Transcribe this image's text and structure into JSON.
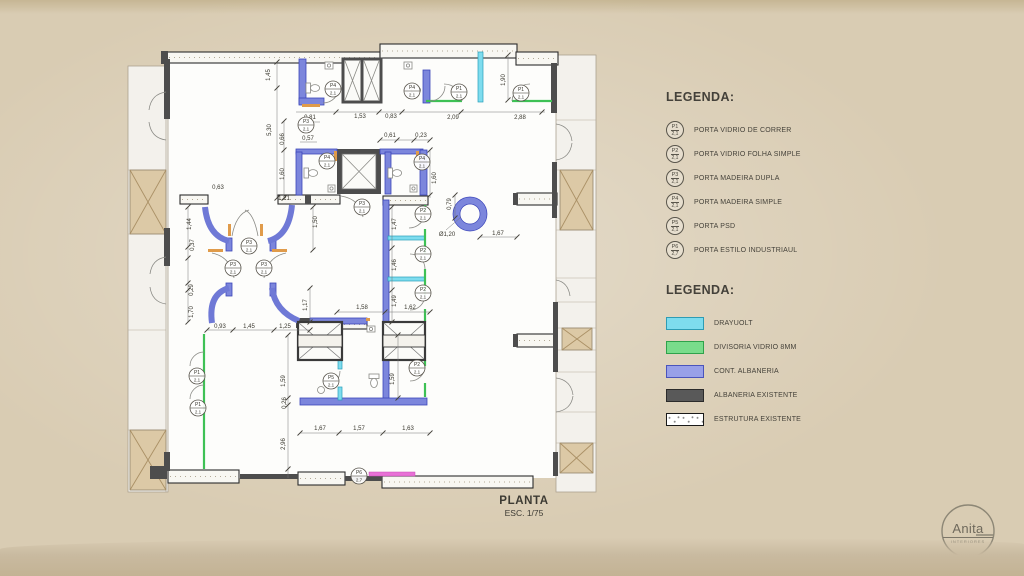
{
  "door_legend": {
    "title": "LEGENDA:",
    "items": [
      {
        "tag": "P1",
        "size": "2,1",
        "label": "PORTA VIDRIO DE CORRER"
      },
      {
        "tag": "P2",
        "size": "2,1",
        "label": "PORTA VIDRIO FOLHA SIMPLE"
      },
      {
        "tag": "P3",
        "size": "2,1",
        "label": "PORTA MADEIRA DUPLA"
      },
      {
        "tag": "P4",
        "size": "2,1",
        "label": "PORTA MADEIRA SIMPLE"
      },
      {
        "tag": "P5",
        "size": "2,1",
        "label": "PORTA PSD"
      },
      {
        "tag": "P6",
        "size": "2,7",
        "label": "PORTA ESTILO INDUSTRIAUL"
      }
    ]
  },
  "material_legend": {
    "title": "LEGENDA:",
    "items": [
      {
        "label": "DRAYUOLT",
        "color": "#7edcee",
        "border": "#2e9cb4",
        "style": "solid"
      },
      {
        "label": "DIVISORIA VIDRIO 8MM",
        "color": "#79dc8b",
        "border": "#2fa24b",
        "style": "solid"
      },
      {
        "label": "CONT. ALBANERIA",
        "color": "#98a0e8",
        "border": "#4a54bc",
        "style": "hatch"
      },
      {
        "label": "ALBANERIA EXISTENTE",
        "color": "#595959",
        "border": "#2b2b2b",
        "style": "solid"
      },
      {
        "label": "ESTRUTURA EXISTENTE",
        "color": "#ffffff",
        "border": "#1a1a1a",
        "style": "speckle"
      }
    ]
  },
  "title_block": {
    "title": "PLANTA",
    "scale": "ESC. 1/75"
  },
  "logo": {
    "name": "Anita",
    "subtitle": "INTERIORES"
  },
  "plan": {
    "door_tags": [
      {
        "tag": "P4",
        "size": "2,1",
        "x": 333,
        "y": 89
      },
      {
        "tag": "P4",
        "size": "2,1",
        "x": 412,
        "y": 91
      },
      {
        "tag": "P1",
        "size": "2,1",
        "x": 459,
        "y": 92
      },
      {
        "tag": "P1",
        "size": "2,1",
        "x": 521,
        "y": 93
      },
      {
        "tag": "P3",
        "size": "2,1",
        "x": 306,
        "y": 125
      },
      {
        "tag": "P4",
        "size": "2,1",
        "x": 327,
        "y": 161
      },
      {
        "tag": "P4",
        "size": "2,1",
        "x": 422,
        "y": 162
      },
      {
        "tag": "P3",
        "size": "2,1",
        "x": 362,
        "y": 207
      },
      {
        "tag": "P3",
        "size": "2,1",
        "x": 249,
        "y": 246
      },
      {
        "tag": "P3",
        "size": "2,1",
        "x": 233,
        "y": 268
      },
      {
        "tag": "P3",
        "size": "2,1",
        "x": 264,
        "y": 268
      },
      {
        "tag": "P2",
        "size": "2,1",
        "x": 423,
        "y": 214
      },
      {
        "tag": "P2",
        "size": "2,1",
        "x": 423,
        "y": 254
      },
      {
        "tag": "P2",
        "size": "2,1",
        "x": 423,
        "y": 293
      },
      {
        "tag": "P2",
        "size": "2,1",
        "x": 417,
        "y": 368
      },
      {
        "tag": "P5",
        "size": "2,1",
        "x": 331,
        "y": 381
      },
      {
        "tag": "P1",
        "size": "2,1",
        "x": 197,
        "y": 376
      },
      {
        "tag": "P1",
        "size": "2,1",
        "x": 198,
        "y": 408
      },
      {
        "tag": "P6",
        "size": "2,7",
        "x": 359,
        "y": 476
      }
    ],
    "dimensions": [
      {
        "t": "1,45",
        "x": 270,
        "y": 75,
        "v": 1
      },
      {
        "t": "5,30",
        "x": 271,
        "y": 130,
        "v": 1
      },
      {
        "t": "0,66",
        "x": 284,
        "y": 139,
        "v": 1
      },
      {
        "t": "1,60",
        "x": 284,
        "y": 174,
        "v": 1
      },
      {
        "t": "0,63",
        "x": 218,
        "y": 189
      },
      {
        "t": "0,81",
        "x": 310,
        "y": 119
      },
      {
        "t": "0,57",
        "x": 308,
        "y": 140
      },
      {
        "t": "1,53",
        "x": 360,
        "y": 118
      },
      {
        "t": "0,83",
        "x": 391,
        "y": 118
      },
      {
        "t": "2,09",
        "x": 453,
        "y": 119
      },
      {
        "t": "2,88",
        "x": 520,
        "y": 119
      },
      {
        "t": "1,90",
        "x": 505,
        "y": 80,
        "v": 1
      },
      {
        "t": "0,61",
        "x": 390,
        "y": 137
      },
      {
        "t": "0,23",
        "x": 421,
        "y": 137
      },
      {
        "t": "1,60",
        "x": 436,
        "y": 178,
        "v": 1
      },
      {
        "t": "1,21",
        "x": 284,
        "y": 200
      },
      {
        "t": "1,50",
        "x": 317,
        "y": 222,
        "v": 1
      },
      {
        "t": "1,44",
        "x": 191,
        "y": 224,
        "v": 1
      },
      {
        "t": "0,37",
        "x": 194,
        "y": 245,
        "v": 1
      },
      {
        "t": "0,29",
        "x": 193,
        "y": 290,
        "v": 1
      },
      {
        "t": "1,70",
        "x": 193,
        "y": 312,
        "v": 1
      },
      {
        "t": "0,93",
        "x": 220,
        "y": 328
      },
      {
        "t": "1,45",
        "x": 249,
        "y": 328
      },
      {
        "t": "1,25",
        "x": 285,
        "y": 328
      },
      {
        "t": "1,17",
        "x": 307,
        "y": 305,
        "v": 1
      },
      {
        "t": "1,58",
        "x": 362,
        "y": 309
      },
      {
        "t": "1,62",
        "x": 410,
        "y": 309
      },
      {
        "t": "1,47",
        "x": 396,
        "y": 224,
        "v": 1
      },
      {
        "t": "1,46",
        "x": 396,
        "y": 265,
        "v": 1
      },
      {
        "t": "1,49",
        "x": 396,
        "y": 301,
        "v": 1
      },
      {
        "t": "0,79",
        "x": 451,
        "y": 204,
        "v": 1
      },
      {
        "t": "Ø1,20",
        "x": 447,
        "y": 236
      },
      {
        "t": "1,67",
        "x": 498,
        "y": 235
      },
      {
        "t": "1,59",
        "x": 285,
        "y": 381,
        "v": 1
      },
      {
        "t": "1,59",
        "x": 394,
        "y": 379,
        "v": 1
      },
      {
        "t": "0,26",
        "x": 286,
        "y": 403,
        "v": 1
      },
      {
        "t": "2,96",
        "x": 285,
        "y": 444,
        "v": 1
      },
      {
        "t": "1,67",
        "x": 320,
        "y": 430
      },
      {
        "t": "1,57",
        "x": 359,
        "y": 430
      },
      {
        "t": "1,63",
        "x": 408,
        "y": 430
      }
    ]
  }
}
